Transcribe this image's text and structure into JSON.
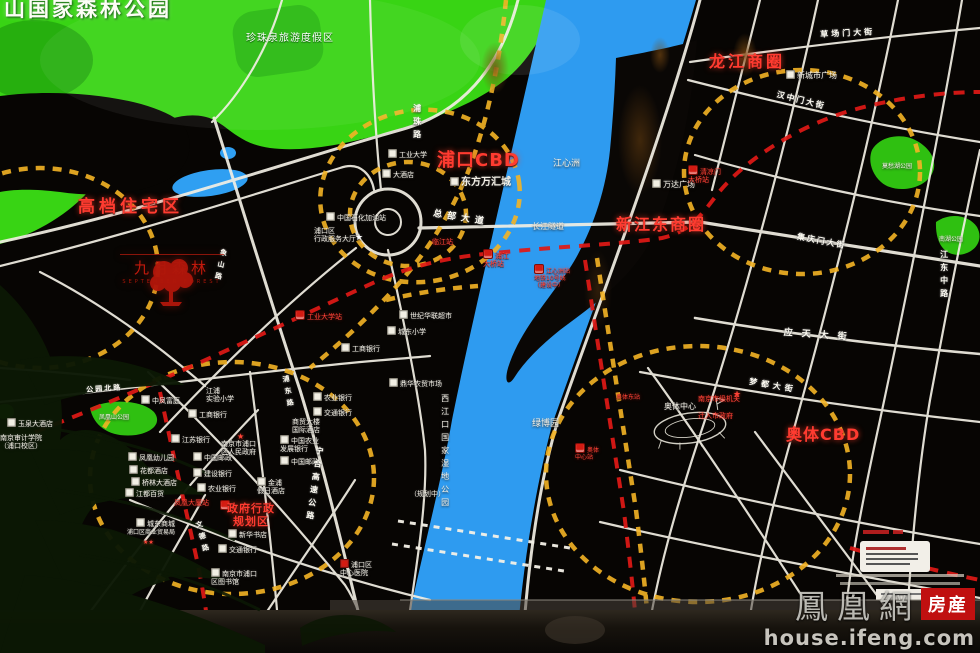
{
  "board": {
    "forest_park": "山国家森林公园",
    "pearl_spring_resort": "珍珠泉旅游度假区",
    "zones": {
      "residential": "高档住宅区",
      "pukou_cbd": "浦口CBD",
      "longjiang": "龙江商圈",
      "xinjiangdong": "新江东商圈",
      "aoti_cbd": "奥体CBD",
      "gov": "政府行政\n规划区"
    },
    "logo": {
      "name": "九月森林",
      "latin": "SEPTEMBER FOREST"
    },
    "gov_note": {
      "line1": "南京市级机关",
      "line2": "迁入市政府"
    }
  },
  "watermark": {
    "brand": "鳳凰網",
    "tag": "房産",
    "url": "house.ifeng.com"
  },
  "colors": {
    "park_green": "#38d414",
    "river_blue": "#2e9bf0",
    "road_white": "#f2efe4",
    "dash_yellow": "#f4b425",
    "metro_red": "#e01916",
    "zone_red": "#ff3b30",
    "brand_red": "#c01010"
  },
  "map": {
    "labels": [
      {
        "t": "东方万汇城",
        "x": 450,
        "y": 177,
        "s": 10,
        "b": 1,
        "ic": "lm",
        "n": "label-dongfang-wanhuicheng"
      },
      {
        "t": "新城市广场",
        "x": 786,
        "y": 70,
        "s": 8,
        "ic": "lm",
        "n": "label-xinchengshi-plaza"
      },
      {
        "t": "万达广场",
        "x": 652,
        "y": 179,
        "s": 8,
        "ic": "lm",
        "n": "label-wanda-plaza"
      },
      {
        "t": "工业大学",
        "x": 388,
        "y": 149,
        "s": 7,
        "ic": "lm"
      },
      {
        "t": "大酒店",
        "x": 382,
        "y": 169,
        "s": 7,
        "ic": "lm"
      },
      {
        "t": "中国石化加油站",
        "x": 326,
        "y": 212,
        "s": 7,
        "ic": "lm"
      },
      {
        "t": "浦口区\n行政服务大厅",
        "x": 314,
        "y": 227,
        "s": 7
      },
      {
        "t": "★",
        "x": 355,
        "y": 233,
        "s": 9,
        "cls": "wstar"
      },
      {
        "t": "世纪华联超市",
        "x": 399,
        "y": 310,
        "s": 7,
        "ic": "lm"
      },
      {
        "t": "城东小学",
        "x": 387,
        "y": 326,
        "s": 7,
        "ic": "lm"
      },
      {
        "t": "鼎华农贸市场",
        "x": 389,
        "y": 378,
        "s": 7,
        "ic": "lm"
      },
      {
        "t": "工商银行",
        "x": 341,
        "y": 343,
        "s": 7,
        "ic": "lm"
      },
      {
        "t": "农业银行",
        "x": 313,
        "y": 392,
        "s": 7,
        "ic": "lm"
      },
      {
        "t": "交通银行",
        "x": 313,
        "y": 407,
        "s": 7,
        "ic": "lm"
      },
      {
        "t": "江浦\n实验小学",
        "x": 206,
        "y": 387,
        "s": 7
      },
      {
        "t": "工商银行",
        "x": 188,
        "y": 409,
        "s": 7,
        "ic": "lm"
      },
      {
        "t": "江苏银行",
        "x": 171,
        "y": 434,
        "s": 7,
        "ic": "lm"
      },
      {
        "t": "中凤富庭",
        "x": 141,
        "y": 395,
        "s": 7,
        "ic": "lm"
      },
      {
        "t": "玉泉大酒店",
        "x": 7,
        "y": 418,
        "s": 7,
        "ic": "lm"
      },
      {
        "t": "南京审计学院\n（浦口校区）",
        "x": 0,
        "y": 434,
        "s": 7
      },
      {
        "t": "凤凰幼儿园",
        "x": 128,
        "y": 452,
        "s": 7,
        "ic": "lm"
      },
      {
        "t": "花都酒店",
        "x": 129,
        "y": 465,
        "s": 7,
        "ic": "lm"
      },
      {
        "t": "桥林大酒店",
        "x": 131,
        "y": 477,
        "s": 7,
        "ic": "lm"
      },
      {
        "t": "江都百货",
        "x": 125,
        "y": 488,
        "s": 7,
        "ic": "lm"
      },
      {
        "t": "商贸大楼\n国际酒店",
        "x": 292,
        "y": 418,
        "s": 7
      },
      {
        "t": "中国农业\n发展银行",
        "x": 280,
        "y": 435,
        "s": 7,
        "ic": "lm"
      },
      {
        "t": "中国邮政",
        "x": 280,
        "y": 456,
        "s": 7,
        "ic": "lm"
      },
      {
        "t": "中国邮政",
        "x": 193,
        "y": 452,
        "s": 7,
        "ic": "lm"
      },
      {
        "t": "建设银行",
        "x": 193,
        "y": 468,
        "s": 7,
        "ic": "lm"
      },
      {
        "t": "农业银行",
        "x": 197,
        "y": 483,
        "s": 7,
        "ic": "lm"
      },
      {
        "t": "南京市浦口\n区人民政府",
        "x": 221,
        "y": 440,
        "s": 7
      },
      {
        "t": "★",
        "x": 237,
        "y": 432,
        "s": 8,
        "cls": "redstar"
      },
      {
        "t": "金浦\n假日酒店",
        "x": 257,
        "y": 477,
        "s": 7,
        "ic": "lm"
      },
      {
        "t": "新华书店",
        "x": 228,
        "y": 529,
        "s": 7,
        "ic": "lm"
      },
      {
        "t": "交通银行",
        "x": 218,
        "y": 544,
        "s": 7,
        "ic": "lm"
      },
      {
        "t": "南京市浦口\n区图书馆",
        "x": 211,
        "y": 568,
        "s": 7,
        "ic": "lm"
      },
      {
        "t": "城东商城",
        "x": 136,
        "y": 518,
        "s": 7,
        "ic": "lm"
      },
      {
        "t": "浦口区商业贸易局",
        "x": 127,
        "y": 529,
        "s": 6
      },
      {
        "t": "★★",
        "x": 143,
        "y": 539,
        "s": 6,
        "cls": "redstar"
      },
      {
        "t": "浦口区\n中心医院",
        "x": 340,
        "y": 559,
        "s": 7,
        "ic": "hp"
      },
      {
        "t": "奥体中心",
        "x": 664,
        "y": 402,
        "s": 8
      },
      {
        "t": "凤凰山公园",
        "x": 99,
        "y": 414,
        "s": 6
      },
      {
        "t": "莫愁湖公园",
        "x": 882,
        "y": 163,
        "s": 6
      },
      {
        "t": "南湖公园",
        "x": 939,
        "y": 236,
        "s": 6
      },
      {
        "t": "江心洲",
        "x": 553,
        "y": 159,
        "s": 9
      },
      {
        "t": "长江隧道",
        "x": 532,
        "y": 222,
        "s": 8
      },
      {
        "t": "绿博园",
        "x": 532,
        "y": 419,
        "s": 9
      },
      {
        "t": "（规划中）",
        "x": 410,
        "y": 490,
        "s": 7
      },
      {
        "t": "西江口国家湿地公园",
        "x": 440,
        "y": 394,
        "s": 8,
        "cls": "v",
        "n": "label-wetland-park"
      },
      {
        "t": "工业大学站",
        "x": 295,
        "y": 310,
        "s": 7,
        "cls": "red",
        "ic": "st"
      },
      {
        "t": "临江站",
        "x": 432,
        "y": 238,
        "s": 7,
        "cls": "red"
      },
      {
        "t": "浦江\n大桥站",
        "x": 483,
        "y": 249,
        "s": 7,
        "cls": "red",
        "ic": "st"
      },
      {
        "t": "江心洲站\n地铁10号线\n（建设中）",
        "x": 534,
        "y": 264,
        "s": 6,
        "cls": "red",
        "ic": "st"
      },
      {
        "t": "清凉门\n大桥站",
        "x": 688,
        "y": 165,
        "s": 7,
        "cls": "red",
        "ic": "st"
      },
      {
        "t": "奥体东站",
        "x": 616,
        "y": 394,
        "s": 6,
        "cls": "red"
      },
      {
        "t": "奥体\n中心站",
        "x": 575,
        "y": 443,
        "s": 6,
        "cls": "red",
        "ic": "st"
      },
      {
        "t": "凤凰大厦站",
        "x": 174,
        "y": 499,
        "s": 7,
        "cls": "red"
      },
      {
        "t": "",
        "x": 220,
        "y": 500,
        "ic": "st"
      },
      {
        "t": "★",
        "x": 733,
        "y": 390,
        "s": 9,
        "cls": "redstar"
      },
      {
        "t": "总部大道",
        "x": 434,
        "y": 209,
        "s": 9,
        "cls": "road",
        "ls": 5,
        "r": 9
      },
      {
        "t": "草场门大街",
        "x": 820,
        "y": 30,
        "s": 8,
        "cls": "road",
        "ls": 3,
        "r": -3
      },
      {
        "t": "汉中门大街",
        "x": 778,
        "y": 90,
        "s": 8,
        "cls": "road",
        "ls": 2,
        "r": 14
      },
      {
        "t": "集庆门大街",
        "x": 798,
        "y": 232,
        "s": 8,
        "cls": "road",
        "ls": 2,
        "r": 11
      },
      {
        "t": "应天大街",
        "x": 784,
        "y": 328,
        "s": 9,
        "cls": "road",
        "ls": 9,
        "r": 4
      },
      {
        "t": "梦都大街",
        "x": 750,
        "y": 377,
        "s": 8,
        "cls": "road",
        "ls": 4,
        "r": 10
      },
      {
        "t": "江东中路",
        "x": 939,
        "y": 250,
        "s": 8,
        "cls": "road v"
      },
      {
        "t": "宁合高速公路",
        "x": 315,
        "y": 446,
        "s": 8,
        "cls": "road v",
        "r": 8
      },
      {
        "t": "公园北路",
        "x": 86,
        "y": 386,
        "s": 7,
        "cls": "road",
        "ls": 2,
        "r": -4
      },
      {
        "t": "文德路",
        "x": 194,
        "y": 522,
        "s": 7,
        "cls": "road v",
        "r": -15
      },
      {
        "t": "浦东路",
        "x": 281,
        "y": 376,
        "s": 7,
        "cls": "road v",
        "r": -10
      },
      {
        "t": "象山路",
        "x": 220,
        "y": 248,
        "s": 7,
        "cls": "road v",
        "r": 12
      },
      {
        "t": "浦珠路",
        "x": 412,
        "y": 104,
        "s": 8,
        "cls": "road v"
      }
    ]
  }
}
